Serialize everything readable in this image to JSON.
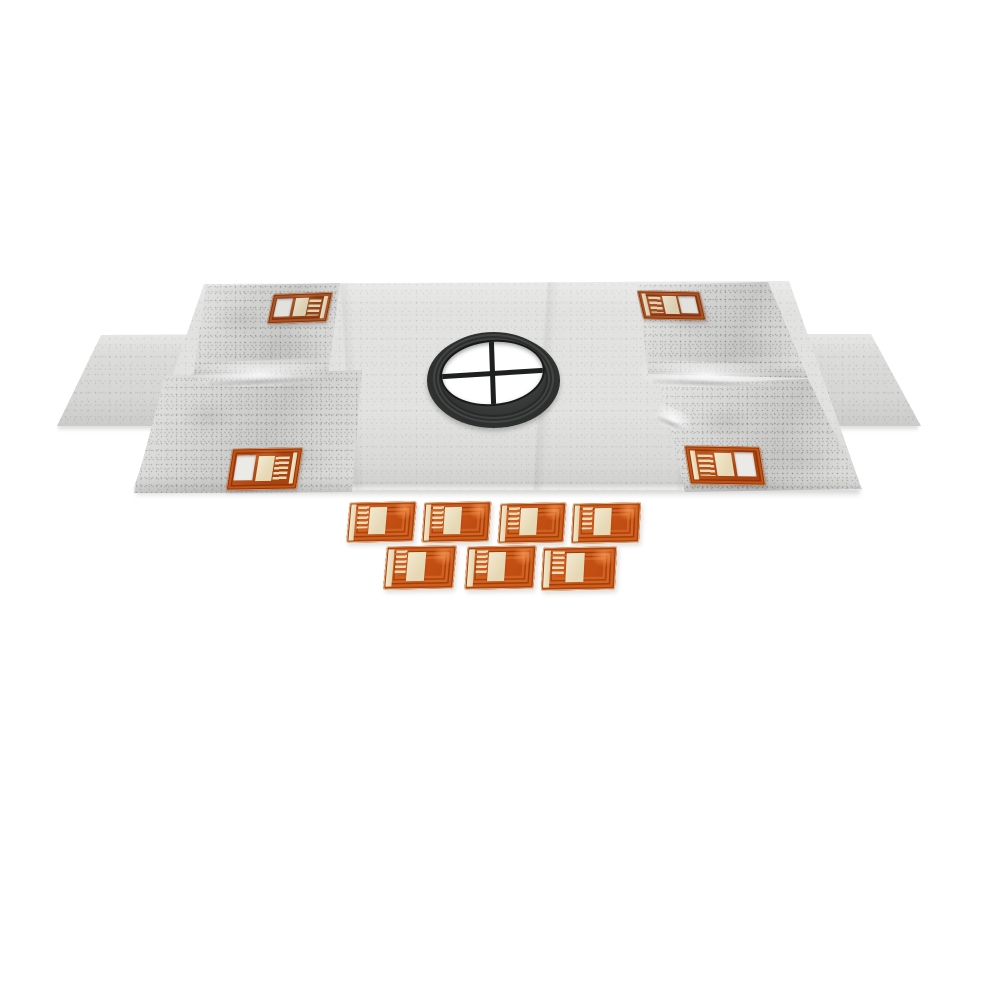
{
  "title": "Waterproofing shower pan membrane kit with drain seal and patch set",
  "description": "Product photo on a white background: a light gray fleece waterproofing membrane laid flat in perspective with four folded, speckled corner flaps and a side wing extending left and right. A black round rubber drain seal with a white circular opening divided by a dark cross sits in the center. Four copper-orange sensor patches with cream pads and square cut-out windows are adhered near the corners, and seven loose copper-orange patches with cream pads are arranged in two rows, four over three, in front of the membrane.",
  "colors": {
    "background": "#ffffff",
    "membrane": "#e2e3e1",
    "membrane_flap": "#d4d5d3",
    "wing": "#dcdddb",
    "drain_ring": "#383b39",
    "drain_opening": "#ffffff",
    "drain_cross": "#1d201e",
    "patch_orange": "#c85116",
    "patch_frame_dark": "#a04008",
    "patch_pad": "#ecdfc0"
  },
  "membrane": {
    "corner_flap_count": 4,
    "side_wing_count": 2
  },
  "drain": {
    "opening_shape": "circle",
    "grate_divider": "cross"
  },
  "patches": {
    "corner_count": 4,
    "loose_count": 7,
    "loose_rows": [
      4,
      3
    ],
    "items": [
      {
        "name": "corner-patch-top-left",
        "variant": "window win-left corner-tl"
      },
      {
        "name": "corner-patch-top-right",
        "variant": "window win-right corner-tr"
      },
      {
        "name": "corner-patch-bottom-left",
        "variant": "window win-left corner-bl"
      },
      {
        "name": "corner-patch-bottom-right",
        "variant": "window win-right corner-br"
      },
      {
        "name": "loose-patch-1",
        "variant": "loose lp1"
      },
      {
        "name": "loose-patch-2",
        "variant": "loose lp2"
      },
      {
        "name": "loose-patch-3",
        "variant": "loose lp3"
      },
      {
        "name": "loose-patch-4",
        "variant": "loose lp4"
      },
      {
        "name": "loose-patch-5",
        "variant": "loose lp5"
      },
      {
        "name": "loose-patch-6",
        "variant": "loose lp6"
      },
      {
        "name": "loose-patch-7",
        "variant": "loose lp7"
      }
    ]
  }
}
